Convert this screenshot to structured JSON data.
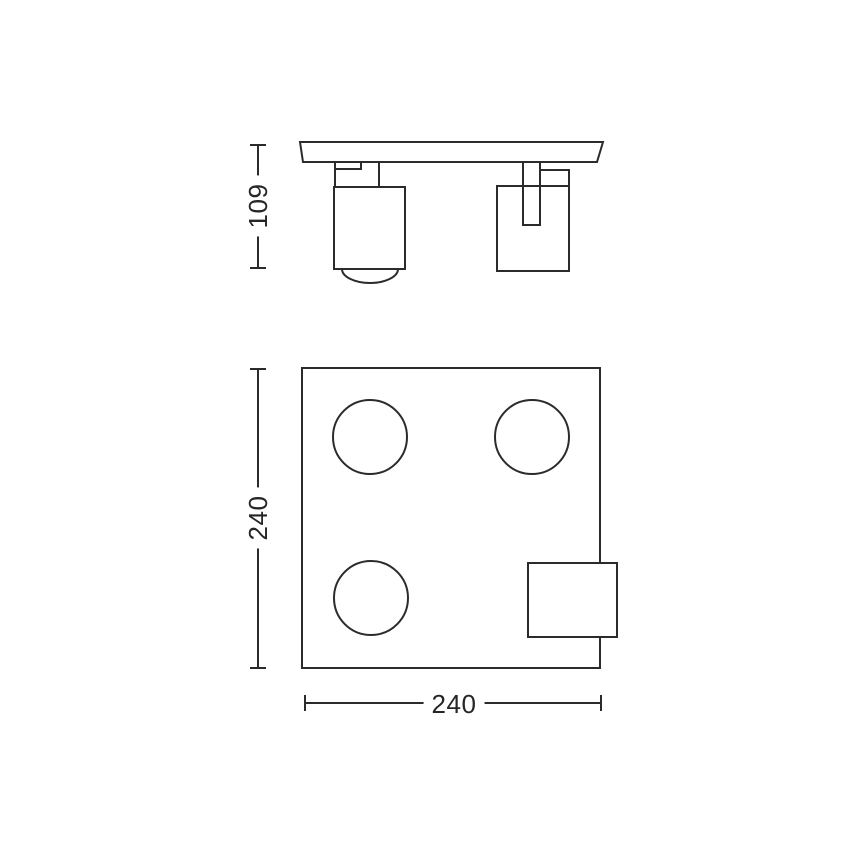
{
  "drawing": {
    "kind": "product-dimension-diagram",
    "colors": {
      "line": "#2b2b2b",
      "background": "#ffffff",
      "text": "#262626"
    },
    "dimensions": {
      "side_height": "109",
      "plan_height": "240",
      "plan_width": "240"
    }
  }
}
